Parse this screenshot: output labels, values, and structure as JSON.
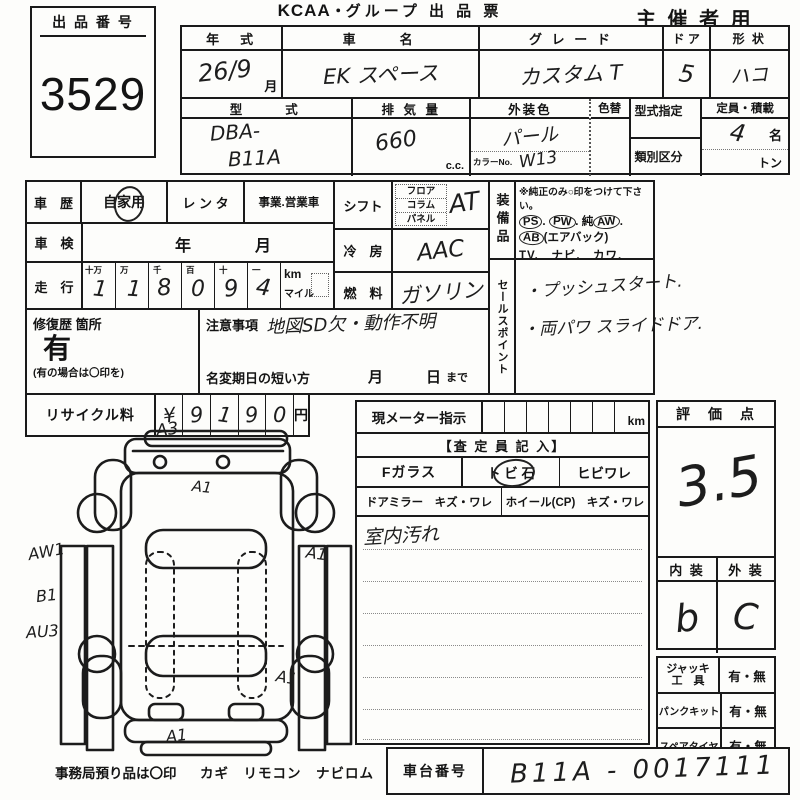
{
  "header": {
    "lot_label": "出 品 番 号",
    "lot_number": "3529",
    "brand": "KCAA",
    "dot": "・",
    "title": "グループ 出 品 票",
    "organizer": "主 催 者 用"
  },
  "spec": {
    "year_label": "年　式",
    "year_value": "26/9",
    "month_label": "月",
    "name_label": "車　　名",
    "name_value": "EK スペース",
    "grade_label": "グ レ ー ド",
    "grade_value": "カスタム T",
    "door_label": "ド ア",
    "door_value": "5",
    "shape_label": "形 状",
    "shape_value": "ハコ",
    "model_label": "型　　式",
    "model_line1": "DBA-",
    "model_line2": "B11A",
    "disp_label": "排 気 量",
    "disp_value": "660",
    "disp_unit": "c.c.",
    "extcolor_label": "外装色",
    "extcolor_value": "パール",
    "colorchange_label": "色替",
    "colorno_label": "カラーNo.",
    "colorno_value": "W13",
    "typedesig_label": "型式指定",
    "classdiv_label": "類別区分",
    "capacity_label": "定員・積載",
    "capacity_value": "4",
    "capacity_unit": "名",
    "ton_label": "トン"
  },
  "history": {
    "label": "車　歴",
    "private": "自家用",
    "rental": "レ ン タ",
    "business": "事業.営業車",
    "inspection_label": "車　検",
    "year_char": "年",
    "month_char": "月",
    "mileage_label": "走　行",
    "digit_labels": [
      "十万",
      "万",
      "千",
      "百",
      "十",
      "一"
    ],
    "digits": [
      "1",
      "1",
      "8",
      "0",
      "9",
      "4"
    ],
    "unit_km": "km",
    "unit_mile": "マイル"
  },
  "shift": {
    "label": "シフト",
    "opt1": "フロア",
    "opt2": "コラム",
    "opt3": "パネル",
    "value": "AT"
  },
  "cooling": {
    "label": "冷　房",
    "value": "AAC"
  },
  "fuel": {
    "label": "燃　料",
    "value": "ガソリン"
  },
  "equipment": {
    "label": "装備品",
    "note": "※純正のみ○印をつけて下さい。",
    "t1": "PS",
    "s1": ".",
    "t2": "PW",
    "s2": ".",
    "t3p": "純",
    "t3": "AW",
    "s3": ".",
    "t4": "AB",
    "t4suf": "(エアバック)",
    "line2": "TV.　ナビ.　カワ.　SR(サンルーフ)",
    "line3": "ABS ・ 新車保証書←(注) 後日送りのみ"
  },
  "sales": {
    "label": "セールスポイント",
    "item1": "・プッシュスタート.",
    "item2": "・両パワ スライドドア."
  },
  "repair": {
    "label": "修復歴 箇所",
    "value": "有",
    "note": "(有の場合は〇印を)"
  },
  "caution": {
    "label": "注意事項",
    "value": "地図SD欠・動作不明",
    "deadline_label": "名変期日の短い方",
    "d_month": "月",
    "d_day": "日",
    "d_made": "まで"
  },
  "recycle": {
    "label": "リサイクル料",
    "yen": "¥",
    "digits": [
      "9",
      "1",
      "9",
      "0"
    ],
    "unit": "円"
  },
  "meter": {
    "label": "現メーター指示",
    "unit": "km",
    "assessor": "【査 定 員 記 入】",
    "fglass": "Fガラス",
    "stone": "ト ビ 石",
    "crack": "ヒビワレ",
    "mirror": "ドアミラー　キズ・ワレ",
    "wheel": "ホイール(CP)　キズ・ワレ",
    "note": "室内汚れ"
  },
  "score": {
    "label": "評　価　点",
    "value": "3.5",
    "interior_label": "内 装",
    "exterior_label": "外 装",
    "interior_value": "b",
    "exterior_value": "C"
  },
  "tools": {
    "jack1": "ジャッキ",
    "jack2": "工　具",
    "jack_v": "有・無",
    "pk": "パンクキット",
    "pk_v": "有・無",
    "spare": "スペアタイヤ",
    "spare_v": "有・無"
  },
  "office": {
    "note": "事務局預り品は〇印",
    "items": "カギ　リモコン　ナビロム"
  },
  "chassis": {
    "label": "車台番号",
    "value": "B11A - 0017111"
  },
  "diagram": {
    "marks": {
      "front": "A3",
      "hood": "A1",
      "left1": "AW1",
      "left2": "B1",
      "left3": "AU3",
      "right1": "A1",
      "right2": "A1",
      "rear": "A1"
    }
  }
}
